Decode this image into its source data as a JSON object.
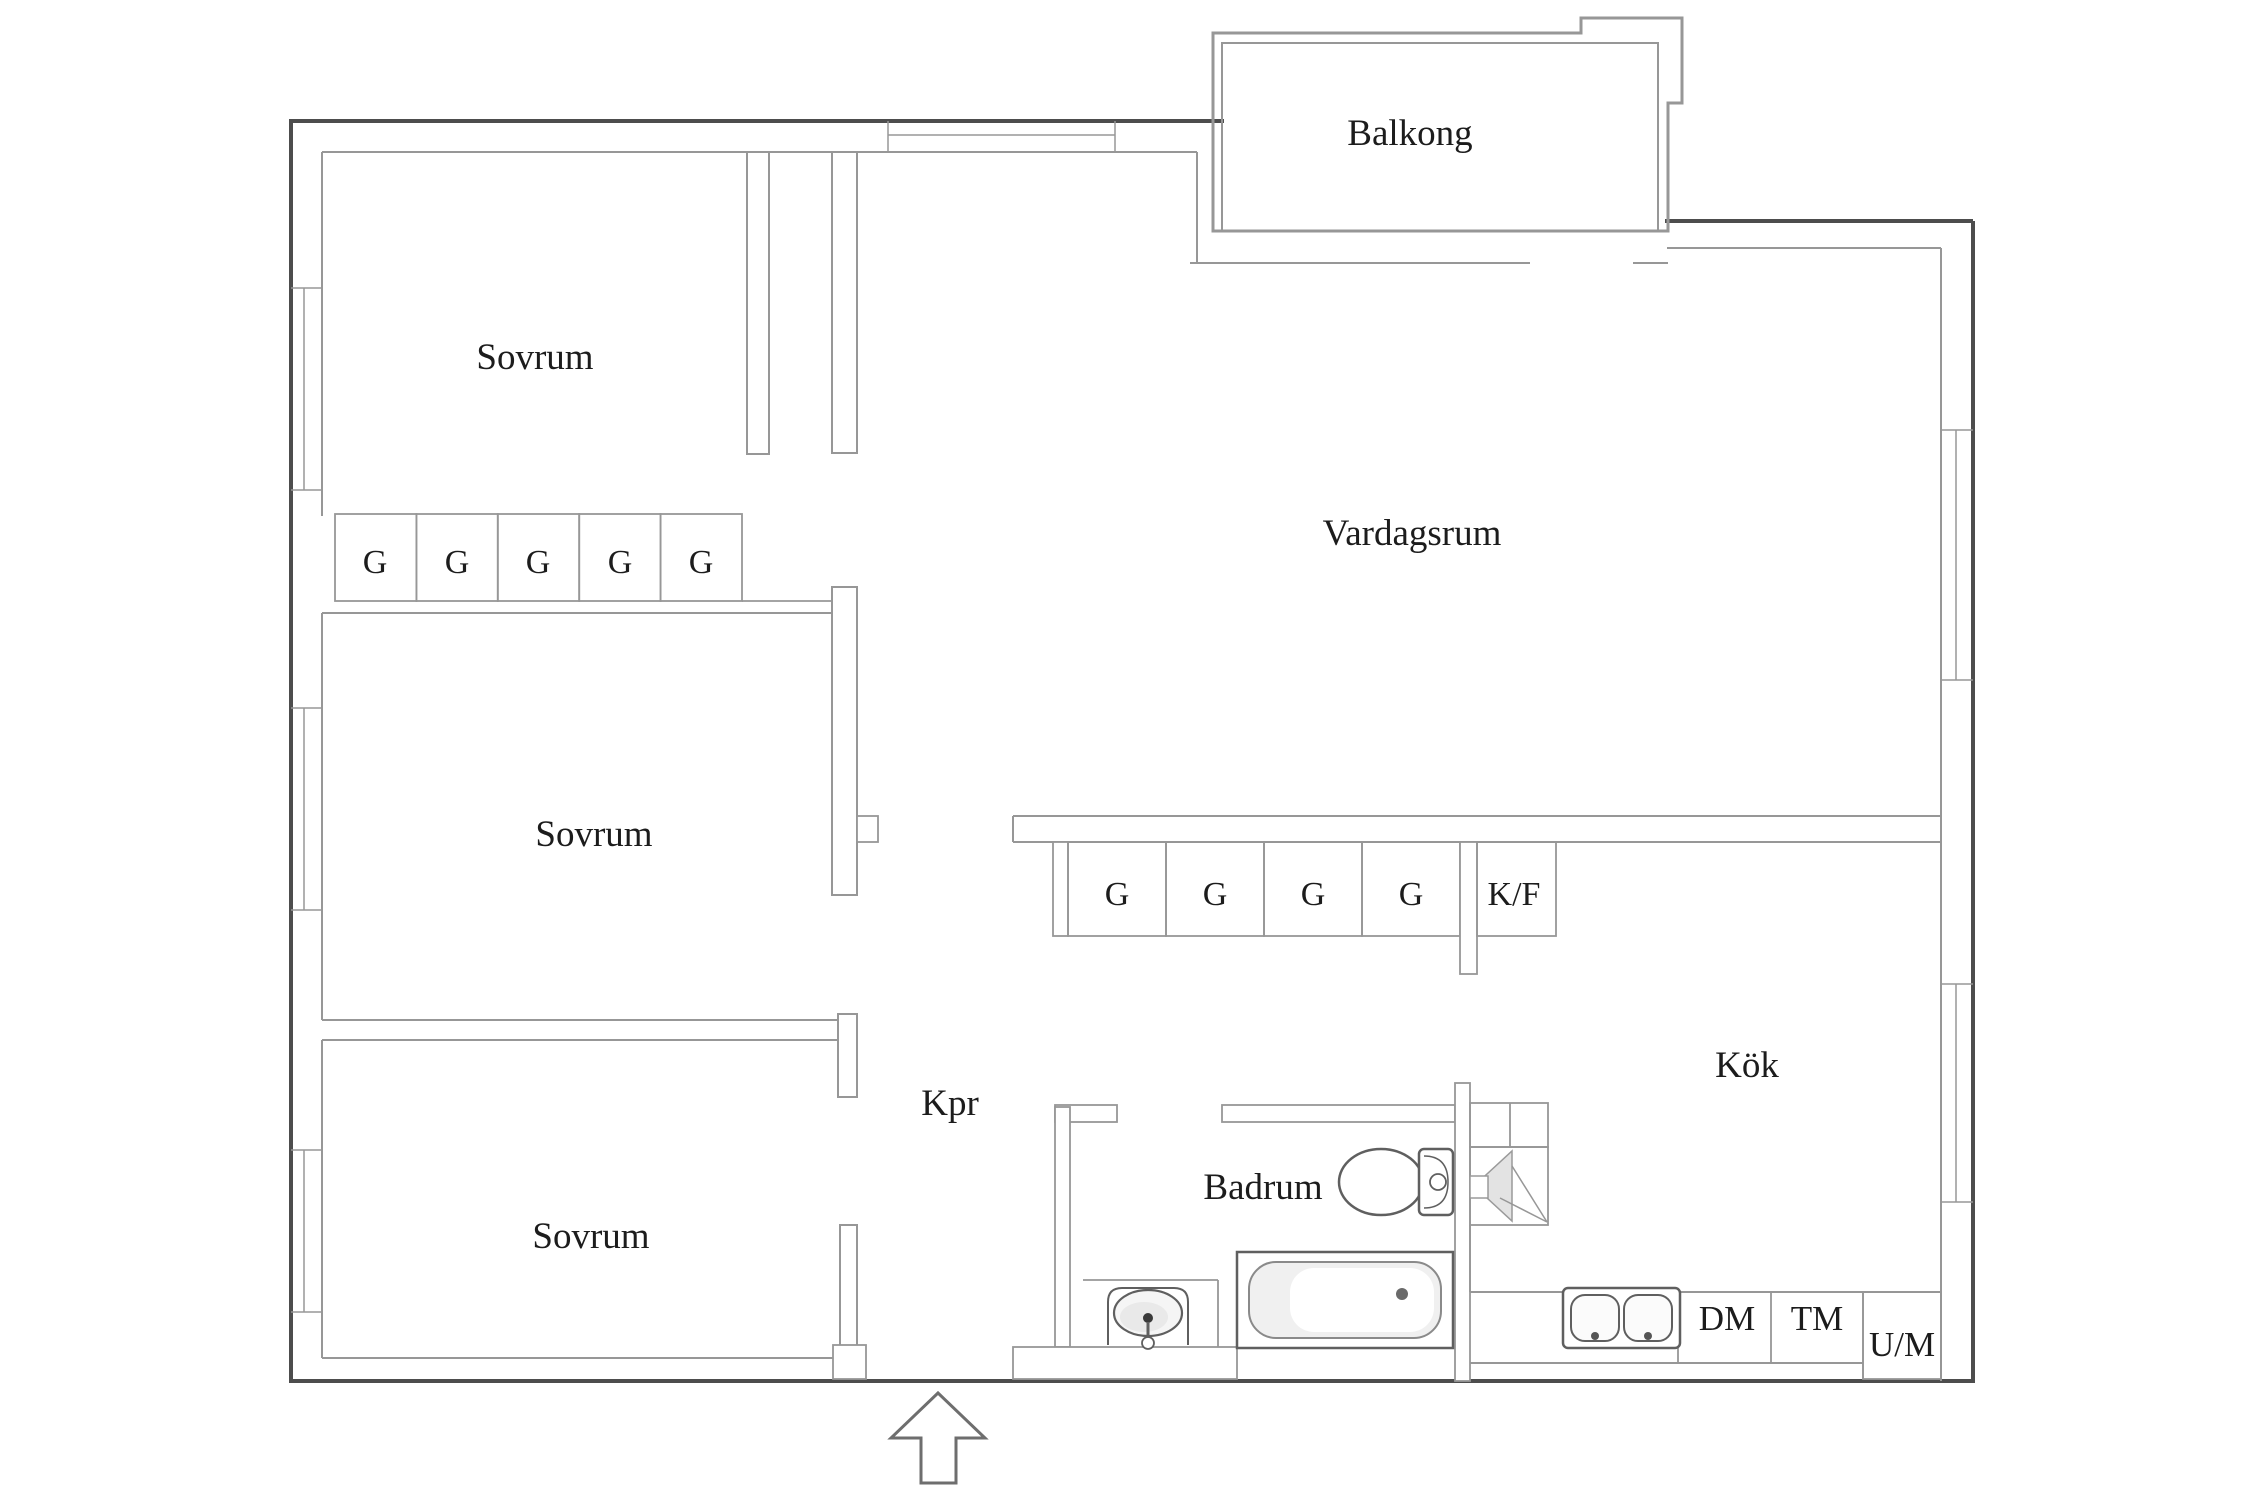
{
  "plan": {
    "balcony_label": "Balkong",
    "livingroom_label": "Vardagsrum",
    "kitchen_label": "Kök",
    "corridor_label": "Kpr",
    "bathroom_label": "Badrum",
    "bedroom_labels": [
      "Sovrum",
      "Sovrum",
      "Sovrum"
    ],
    "bedroom_closets": [
      "G",
      "G",
      "G",
      "G",
      "G"
    ],
    "hall_closets": [
      "G",
      "G",
      "G",
      "G"
    ],
    "fridge_freezer_label": "K/F",
    "dishwasher_label": "DM",
    "washing_machine_label": "TM",
    "oven_microwave_label": "U/M"
  },
  "colors": {
    "outer_wall": "#4d4d4d",
    "inner_wall": "#979797",
    "fixture_stroke": "#5f5f5f",
    "shading": "#e3e3e3",
    "text": "#1c1c1c",
    "background": "#ffffff"
  }
}
